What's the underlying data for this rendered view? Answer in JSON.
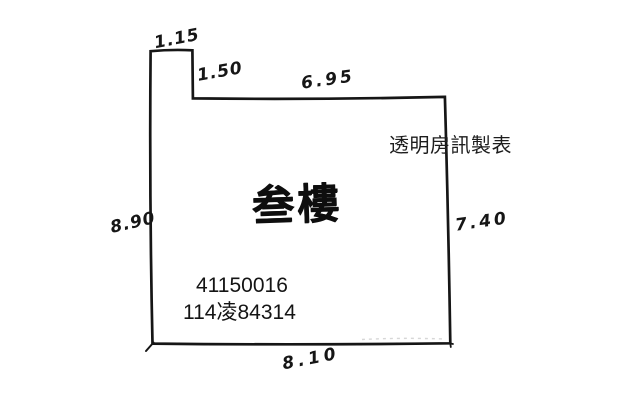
{
  "page": {
    "background_color": "#ffffff",
    "ink_color": "#161616"
  },
  "plan": {
    "floor_label": "叁樓",
    "credit_text": "透明房訊製表",
    "id_line1": "41150016",
    "id_line2": "114凌84314",
    "dimensions": {
      "top_notch_width": "1.15",
      "notch_depth": "1.50",
      "top_width": "6.95",
      "left_height": "8.90",
      "right_height": "7.40",
      "bottom_width": "8.10"
    }
  }
}
